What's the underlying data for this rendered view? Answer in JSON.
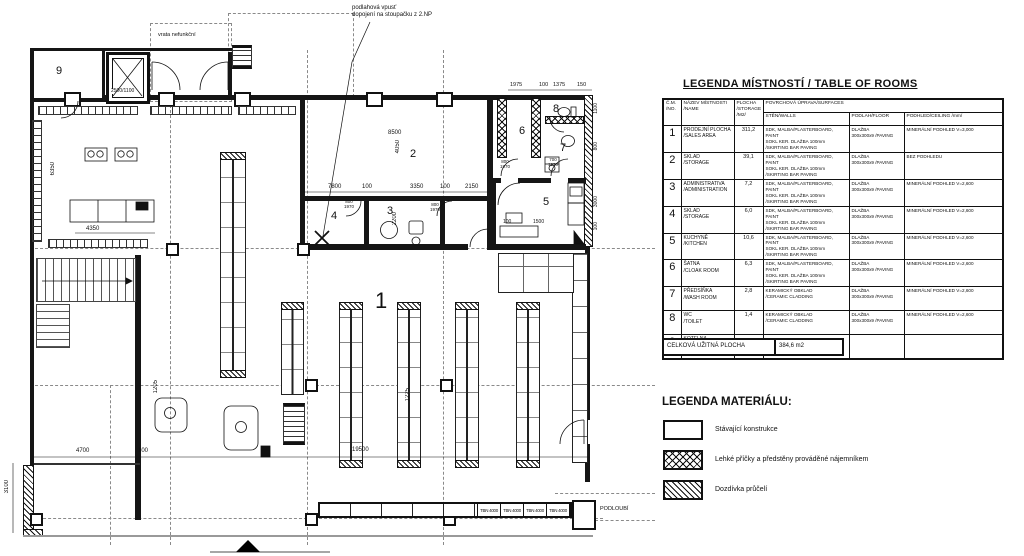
{
  "plan": {
    "rooms": {
      "n1": "1",
      "n2": "2",
      "n3": "3",
      "n4": "4",
      "n5": "5",
      "n6": "6",
      "n7": "7",
      "n8": "8",
      "n9": "9"
    },
    "notes": {
      "drain": "podlahová vpusť\ndopojení na stoupačku z 2.NP",
      "gate": "vrata nefunkční",
      "arcade": "PODLOUBÍ",
      "window_cell": "TBN 4000",
      "elevator": "2500/1100"
    },
    "dims": {
      "t1": "1975",
      "t2": "100",
      "t3": "1375",
      "t4": "150",
      "r2w": "8500",
      "r2h": "4050",
      "c1": "7800",
      "c2": "100",
      "c3": "3350",
      "c4": "100",
      "c5": "2150",
      "r3h": "2200",
      "left_h": "6350",
      "counter": "4350",
      "b1": "4700",
      "b2": "100",
      "b3": "3100",
      "b4": "19500",
      "k1": "100",
      "k2": "1500",
      "v1": "1205",
      "v2": "1225",
      "rr1": "1100",
      "rr2": "800",
      "rr3": "3000",
      "rr4": "100",
      "door_a": "800\n1970",
      "door_b": "800\n1970",
      "door_c": "800\n1970",
      "door_d": "700\n1970"
    }
  },
  "rooms_table": {
    "title": "LEGENDA MÍSTNOSTÍ / TABLE OF ROOMS",
    "headers": {
      "no": "Č.M.\n/NO.",
      "name": "NÁZEV MÍSTNOSTI\n/NAME",
      "area": "PLOCHA\n/STORAGE\n/M2/",
      "surfaces": "POVRCHOVÁ ÚPRAVA/SURFACES",
      "walls": "STĚN/WALLS",
      "floor": "PODLAH/FLOOR",
      "ceiling": "PODHLED/CEILING  /mm/"
    },
    "rows": [
      {
        "no": "1",
        "name": "PRODEJNÍ PLOCHA\n/SALES AREA",
        "area": "311,2",
        "walls": "SDK, MALBA/PLASTERBOARD, PAINT\nSOKL KER. DLAŽBA 100mm\n/SKIRTING BAR PAVING",
        "floor": "DLAŽBA\n300x300x9   /PAVING",
        "ceiling": "MINERÁLNÍ PODHLED V=3,000"
      },
      {
        "no": "2",
        "name": "SKLAD\n/STORAGE",
        "area": "39,1",
        "walls": "SDK, MALBA/PLASTERBOARD, PAINT\nSOKL KER. DLAŽBA 100mm\n/SKIRTING BAR PAVING",
        "floor": "DLAŽBA\n300x300x9   /PAVING",
        "ceiling": "BEZ PODHLEDU"
      },
      {
        "no": "3",
        "name": "ADMINISTRATIVA\n/ADMINISTRATION",
        "area": "7,2",
        "walls": "SDK, MALBA/PLASTERBOARD, PAINT\nSOKL KER. DLAŽBA 100mm\n/SKIRTING BAR PAVING",
        "floor": "DLAŽBA\n300x300x9   /PAVING",
        "ceiling": "MINERÁLNÍ PODHLED V=2,600"
      },
      {
        "no": "4",
        "name": "SKLAD\n/STORAGE",
        "area": "6,0",
        "walls": "SDK, MALBA/PLASTERBOARD, PAINT\nSOKL KER. DLAŽBA 100mm\n/SKIRTING BAR PAVING",
        "floor": "DLAŽBA\n300x300x9   /PAVING",
        "ceiling": "MINERÁLNÍ PODHLED V=2,600"
      },
      {
        "no": "5",
        "name": "KUCHYNĚ\n/KITCHEN",
        "area": "10,6",
        "walls": "SDK, MALBA/PLASTERBOARD, PAINT\nSOKL KER. DLAŽBA 100mm\n/SKIRTING BAR PAVING",
        "floor": "DLAŽBA\n300x300x9   /PAVING",
        "ceiling": "MINERÁLNÍ PODHLED V=2,600"
      },
      {
        "no": "6",
        "name": "ŠATNA\n/CLOAK ROOM",
        "area": "6,3",
        "walls": "SDK, MALBA/PLASTERBOARD, PAINT\nSOKL KER. DLAŽBA 100mm\n/SKIRTING BAR PAVING",
        "floor": "DLAŽBA\n300x300x9   /PAVING",
        "ceiling": "MINERÁLNÍ PODHLED V=2,600"
      },
      {
        "no": "7",
        "name": "PŘEDSÍŇKA\n/WASH ROOM",
        "area": "2,8",
        "walls": "KERAMICKÝ OBKLAD\n/CERAMIC CLADDING",
        "floor": "DLAŽBA\n300x300x9   /PAVING",
        "ceiling": "MINERÁLNÍ PODHLED V=2,600"
      },
      {
        "no": "8",
        "name": "WC\n/TOILET",
        "area": "1,4",
        "walls": "KERAMICKÝ OBKLAD\n/CERAMIC CLADDING",
        "floor": "DLAŽBA\n300x300x9   /PAVING",
        "ceiling": "MINERÁLNÍ PODHLED V=2,600"
      },
      {
        "no": "9",
        "name": "KOTELNA\n/BOILER ROOM",
        "area": "",
        "walls": "",
        "floor": "",
        "ceiling": ""
      }
    ],
    "total_label": "CELKOVÁ UŽITNÁ PLOCHA",
    "total_value": "384,6 m2"
  },
  "materials": {
    "title": "LEGENDA MATERIÁLU:",
    "items": [
      {
        "label": "Stávající konstrukce",
        "pattern": "solid"
      },
      {
        "label": "Lehké příčky a předstěny prováděné nájemníkem",
        "pattern": "crosshatch"
      },
      {
        "label": "Dozdívka průčelí",
        "pattern": "diagonal"
      }
    ]
  }
}
